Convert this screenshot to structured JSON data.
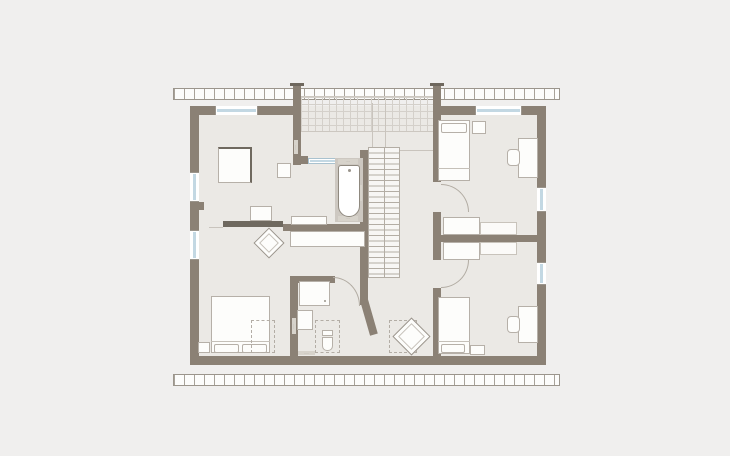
{
  "scene": {
    "kind": "architectural floor plan, upper storey",
    "colors": {
      "background": "#f0efee",
      "wall": "#8b8175",
      "floor": "#ebe9e5",
      "window_glazing": "#c3d8e3",
      "thin_line": "#b2aca3",
      "dark_furniture": "#6f695f"
    }
  },
  "stamps": {
    "micro": "·····"
  },
  "plan": {
    "rooms": [
      {
        "id": "bedroom-northwest",
        "furniture": [
          "wardrobe",
          "wall-cabinet",
          "desk",
          "chair"
        ]
      },
      {
        "id": "master-bedroom-southwest",
        "furniture": [
          "double-bed",
          "bench",
          "dashed-rug"
        ]
      },
      {
        "id": "bathroom-center",
        "fixtures": [
          "bathtub",
          "vanity",
          "glass-partition",
          "built-in-wardrobe"
        ]
      },
      {
        "id": "shower-wc-center-south",
        "fixtures": [
          "shower",
          "washbasin",
          "wc"
        ]
      },
      {
        "id": "bedroom-northeast",
        "furniture": [
          "single-bed",
          "nightstand",
          "desk",
          "chair",
          "closet"
        ]
      },
      {
        "id": "bedroom-southeast",
        "furniture": [
          "single-bed",
          "bench",
          "desk",
          "chair",
          "closet"
        ]
      },
      {
        "id": "hallway-landing",
        "furniture": [
          "armchair",
          "dashed-rug"
        ],
        "features": [
          "double-flight-staircase",
          "gallery-grid"
        ]
      }
    ],
    "window_count": 6,
    "door_arc_count": 3,
    "roof_edge_bands": 2
  }
}
